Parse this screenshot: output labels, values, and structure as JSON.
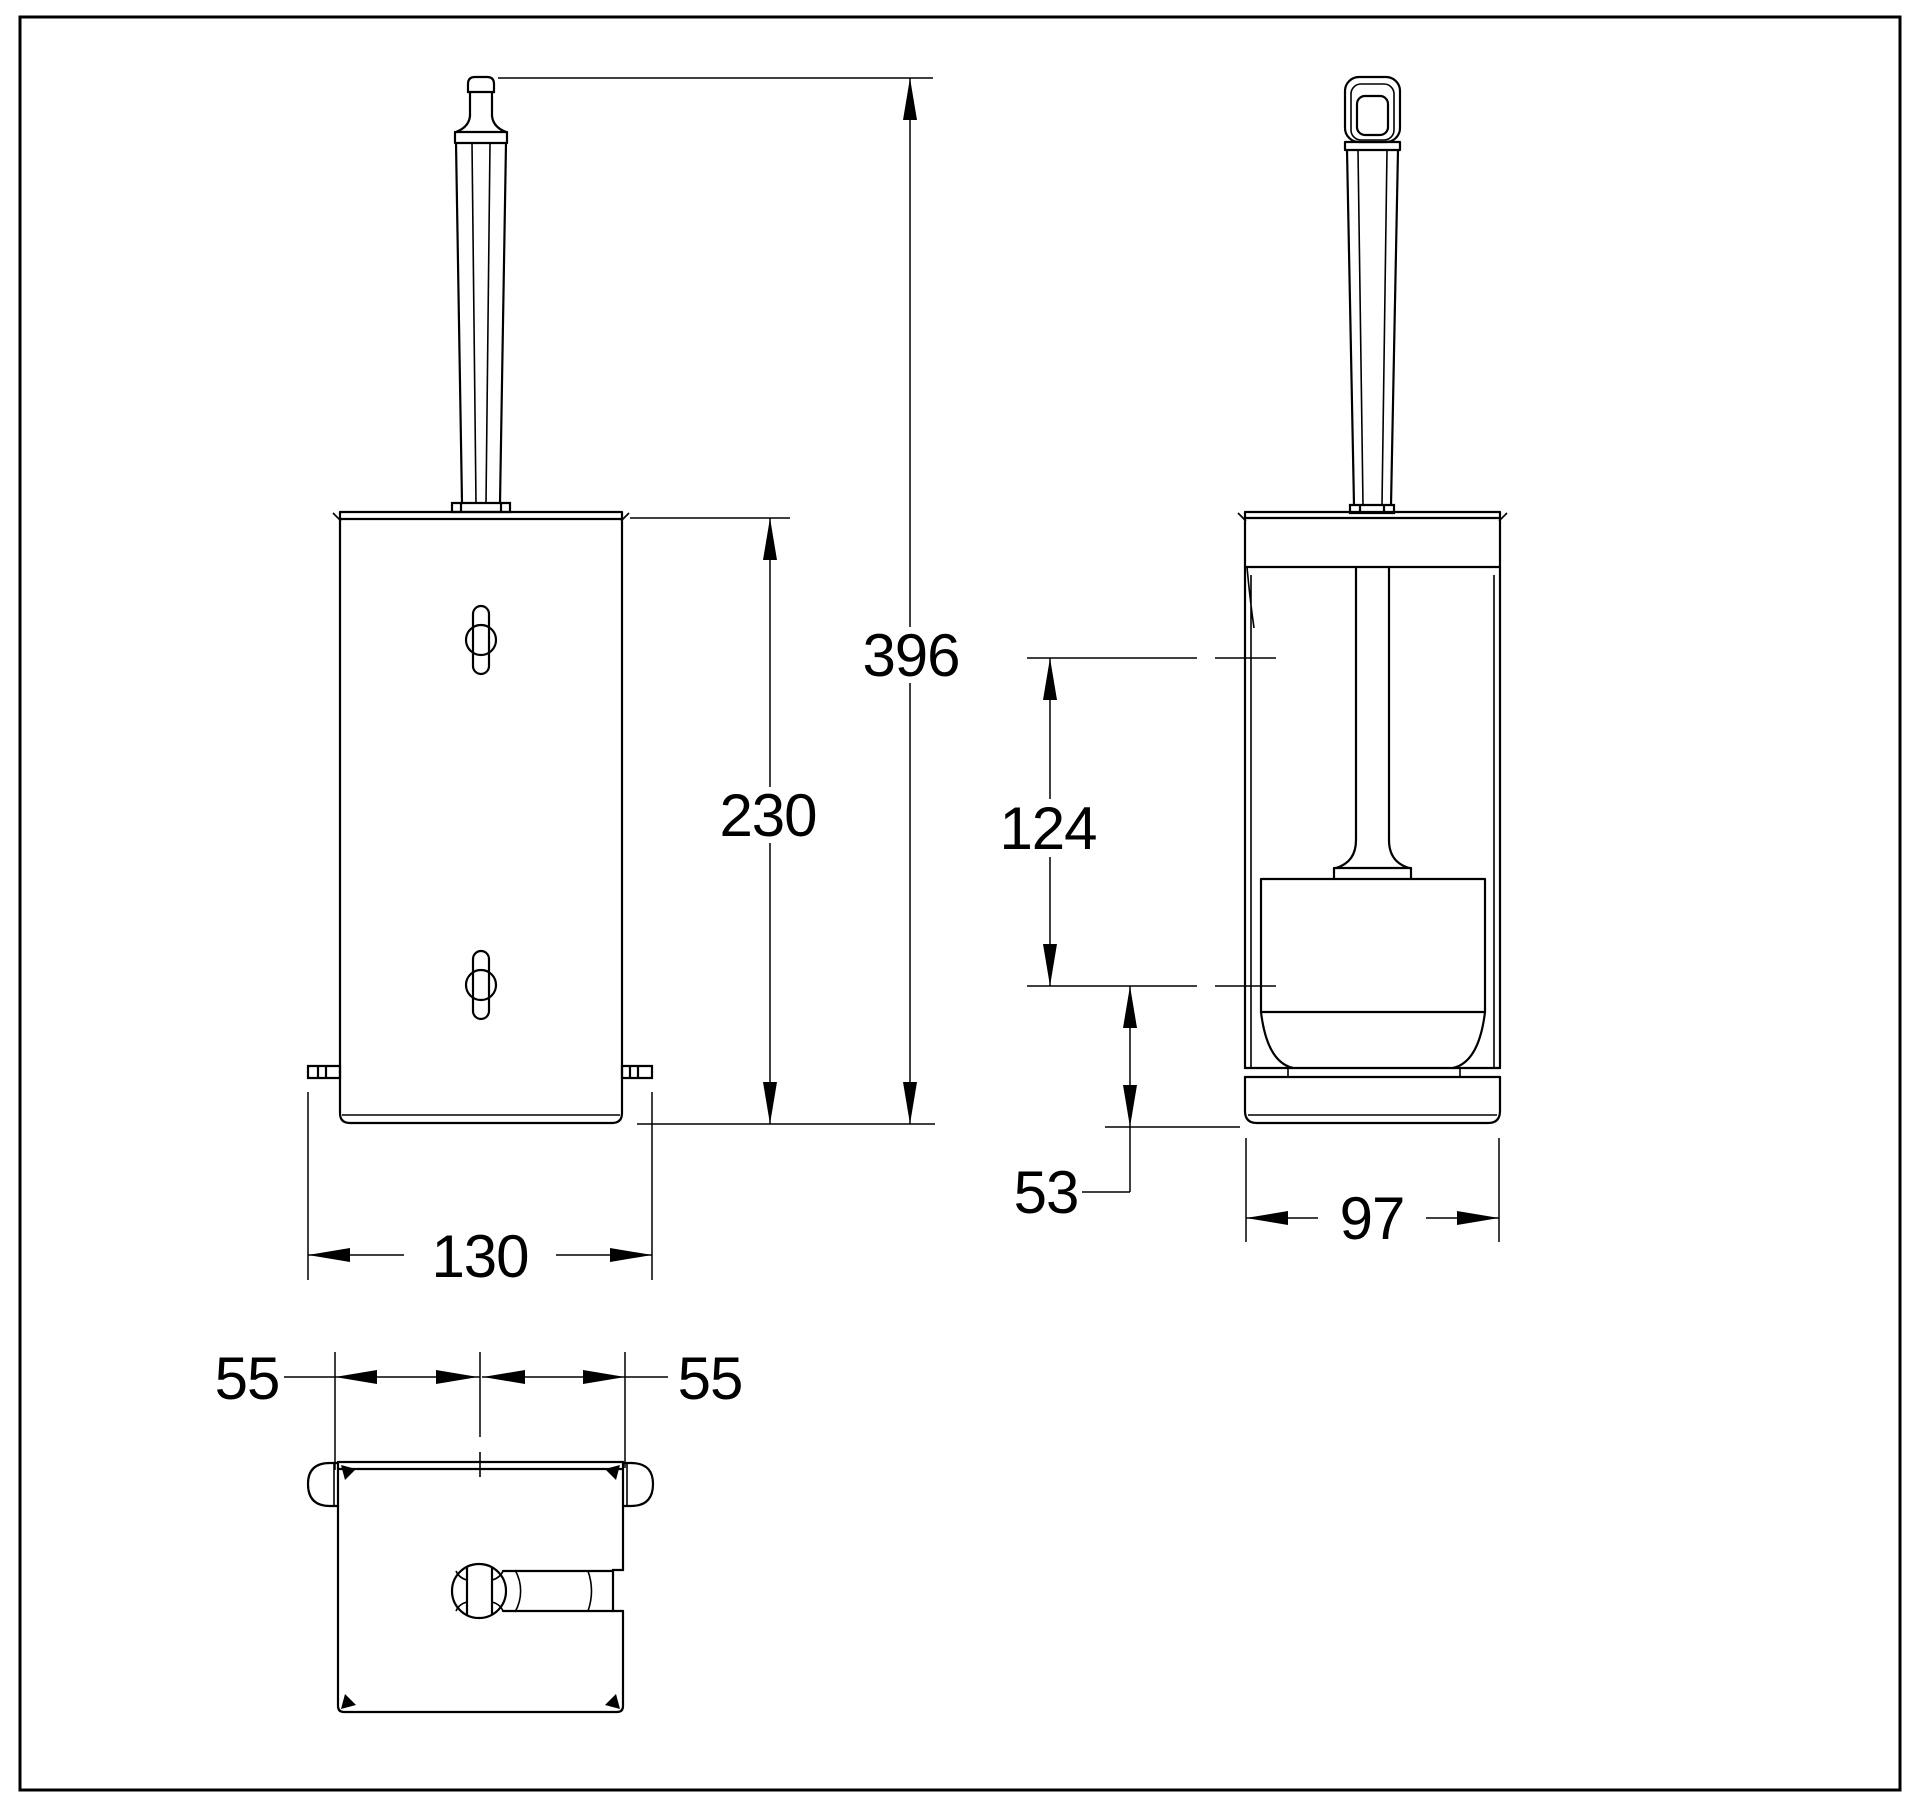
{
  "drawing": {
    "background": "#ffffff",
    "line_color": "#000000",
    "dimension_labels": {
      "overall_height": "396",
      "body_height": "230",
      "inner_depth": "124",
      "base_offset": "53",
      "front_width": "130",
      "side_width": "97",
      "half_depth_left": "55",
      "half_depth_right": "55"
    }
  }
}
